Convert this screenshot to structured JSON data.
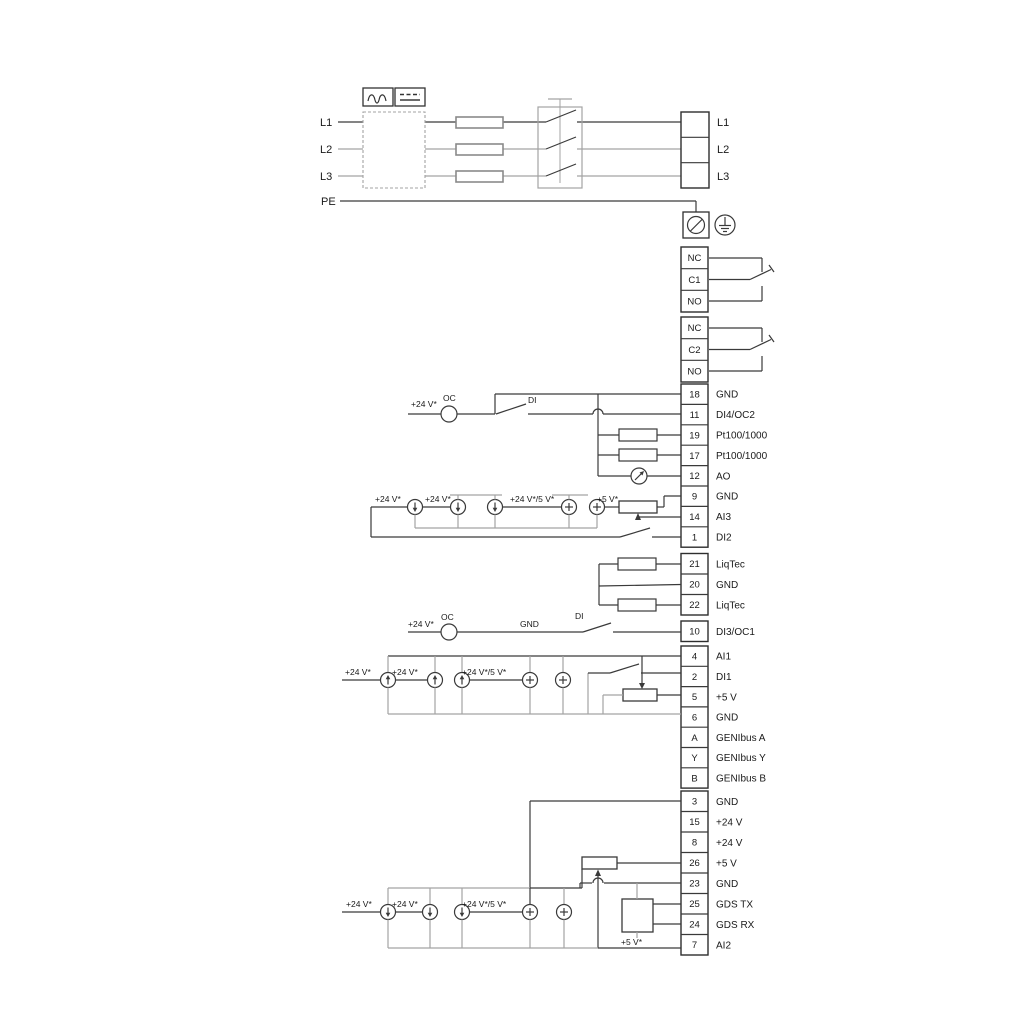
{
  "power": {
    "left_labels": [
      "L1",
      "L2",
      "L3",
      "PE"
    ],
    "right_terminals": [
      "L1",
      "L2",
      "L3"
    ]
  },
  "relays": [
    [
      "NC",
      "C1",
      "NO"
    ],
    [
      "NC",
      "C2",
      "NO"
    ]
  ],
  "terminal_groups": [
    {
      "name": "io-top",
      "rows": [
        [
          "18",
          "GND"
        ],
        [
          "11",
          "DI4/OC2"
        ],
        [
          "19",
          "Pt100/1000"
        ],
        [
          "17",
          "Pt100/1000"
        ],
        [
          "12",
          "AO"
        ],
        [
          "9",
          "GND"
        ],
        [
          "14",
          "AI3"
        ],
        [
          "1",
          "DI2"
        ]
      ]
    },
    {
      "name": "liqtec",
      "rows": [
        [
          "21",
          "LiqTec"
        ],
        [
          "20",
          "GND"
        ],
        [
          "22",
          "LiqTec"
        ]
      ]
    },
    {
      "name": "di3",
      "rows": [
        [
          "10",
          "DI3/OC1"
        ]
      ]
    },
    {
      "name": "io-mid",
      "rows": [
        [
          "4",
          "AI1"
        ],
        [
          "2",
          "DI1"
        ],
        [
          "5",
          "+5 V"
        ],
        [
          "6",
          "GND"
        ],
        [
          "A",
          "GENIbus A"
        ],
        [
          "Y",
          "GENIbus Y"
        ],
        [
          "B",
          "GENIbus B"
        ]
      ]
    },
    {
      "name": "io-bottom",
      "rows": [
        [
          "3",
          "GND"
        ],
        [
          "15",
          "+24 V"
        ],
        [
          "8",
          "+24 V"
        ],
        [
          "26",
          "+5 V"
        ],
        [
          "23",
          "GND"
        ],
        [
          "25",
          "GDS TX"
        ],
        [
          "24",
          "GDS RX"
        ],
        [
          "7",
          "AI2"
        ]
      ]
    }
  ],
  "annotations": [
    {
      "text": "+24 V*",
      "x": 411,
      "y": 407
    },
    {
      "text": "OC",
      "x": 443,
      "y": 401
    },
    {
      "text": "DI",
      "x": 528,
      "y": 403
    },
    {
      "text": "+24 V*",
      "x": 375,
      "y": 502
    },
    {
      "text": "+24 V*",
      "x": 425,
      "y": 502
    },
    {
      "text": "+24 V*/5 V*",
      "x": 510,
      "y": 502
    },
    {
      "text": "+5 V*",
      "x": 597,
      "y": 502
    },
    {
      "text": "+24 V*",
      "x": 408,
      "y": 627
    },
    {
      "text": "OC",
      "x": 441,
      "y": 620
    },
    {
      "text": "GND",
      "x": 520,
      "y": 627
    },
    {
      "text": "DI",
      "x": 575,
      "y": 619
    },
    {
      "text": "+24 V*",
      "x": 345,
      "y": 675
    },
    {
      "text": "+24 V*",
      "x": 392,
      "y": 675
    },
    {
      "text": "+24 V*/5 V*",
      "x": 462,
      "y": 675
    },
    {
      "text": "+24 V*",
      "x": 346,
      "y": 907
    },
    {
      "text": "+24 V*",
      "x": 392,
      "y": 907
    },
    {
      "text": "+24 V*/5 V*",
      "x": 462,
      "y": 907
    },
    {
      "text": "+5 V*",
      "x": 621,
      "y": 945
    }
  ],
  "colors": {
    "line_dark": "#3a3a3a",
    "line_gray": "#a3a3a3",
    "text": "#1a1a1a"
  }
}
